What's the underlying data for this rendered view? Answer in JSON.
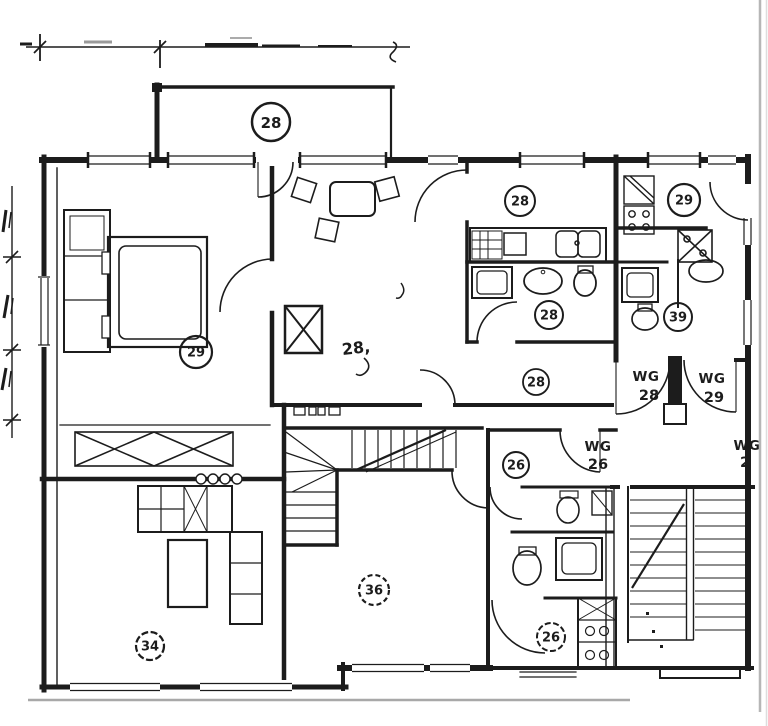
{
  "colors": {
    "ink": "#1c1c1c",
    "paper": "#ffffff",
    "scan_border_gray": "#b6b6b6"
  },
  "rooms": [
    {
      "key": "balcony",
      "label": "28"
    },
    {
      "key": "bedroom",
      "label": "29"
    },
    {
      "key": "living_room",
      "label": "28,"
    },
    {
      "key": "kitchen_left",
      "label": "28"
    },
    {
      "key": "bath_left",
      "label": "28"
    },
    {
      "key": "hall_left",
      "label": "28"
    },
    {
      "key": "kitchen_right",
      "label": "29"
    },
    {
      "key": "bath_right",
      "label": "39"
    },
    {
      "key": "hall_wg26",
      "label": "26"
    },
    {
      "key": "room_center",
      "label": "36"
    },
    {
      "key": "room_bottom_left",
      "label": "34"
    },
    {
      "key": "bath_wg26",
      "label": "26"
    }
  ],
  "apartment_labels": [
    {
      "key": "wg28",
      "line1": "WG",
      "line2": "28"
    },
    {
      "key": "wg29",
      "line1": "WG",
      "line2": "29"
    },
    {
      "key": "wg26",
      "line1": "WG",
      "line2": "26"
    },
    {
      "key": "wg_edge",
      "line1": "WG",
      "line2": "2"
    }
  ]
}
